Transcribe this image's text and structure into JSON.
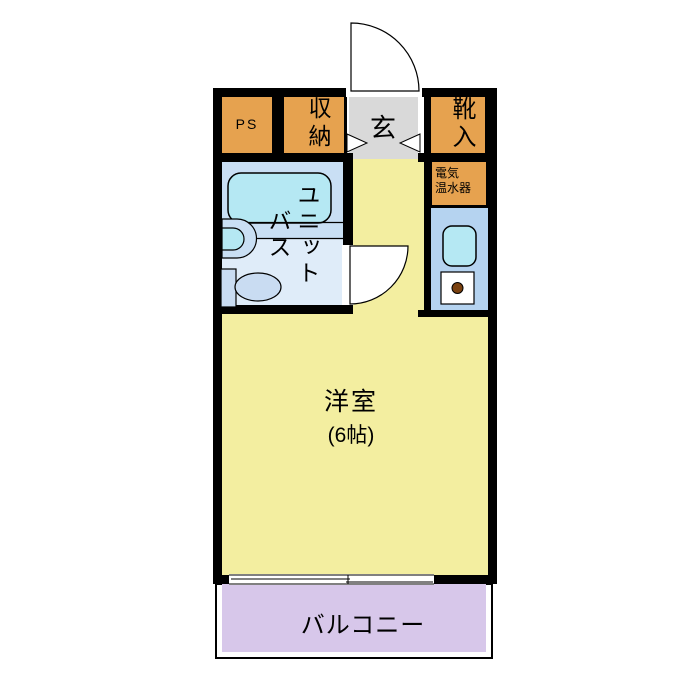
{
  "floorplan": {
    "rooms": {
      "ps": {
        "label": "PS"
      },
      "closet": {
        "label": "収納"
      },
      "entrance": {
        "label": "玄"
      },
      "shoe_cabinet": {
        "label": "靴入"
      },
      "water_heater": {
        "line1": "電気",
        "line2": "温水器"
      },
      "unit_bath": {
        "column1": "ユニット",
        "column2": "バス"
      },
      "western_room": {
        "label": "洋室",
        "size": "(6帖)"
      },
      "balcony": {
        "label": "バルコニー"
      }
    },
    "colors": {
      "wall": "#000000",
      "orange": "#e6a24f",
      "yellow": "#f3eea0",
      "gray": "#d9d9d9",
      "bath_upper": "#c9dff4",
      "bath_lower": "#dfecf9",
      "cyan": "#b5e8f3",
      "kitchen_blue": "#b5d3f0",
      "lavender": "#d7c7ea",
      "toilet_blue": "#c9dcf2",
      "burner": "#7a4110"
    }
  }
}
